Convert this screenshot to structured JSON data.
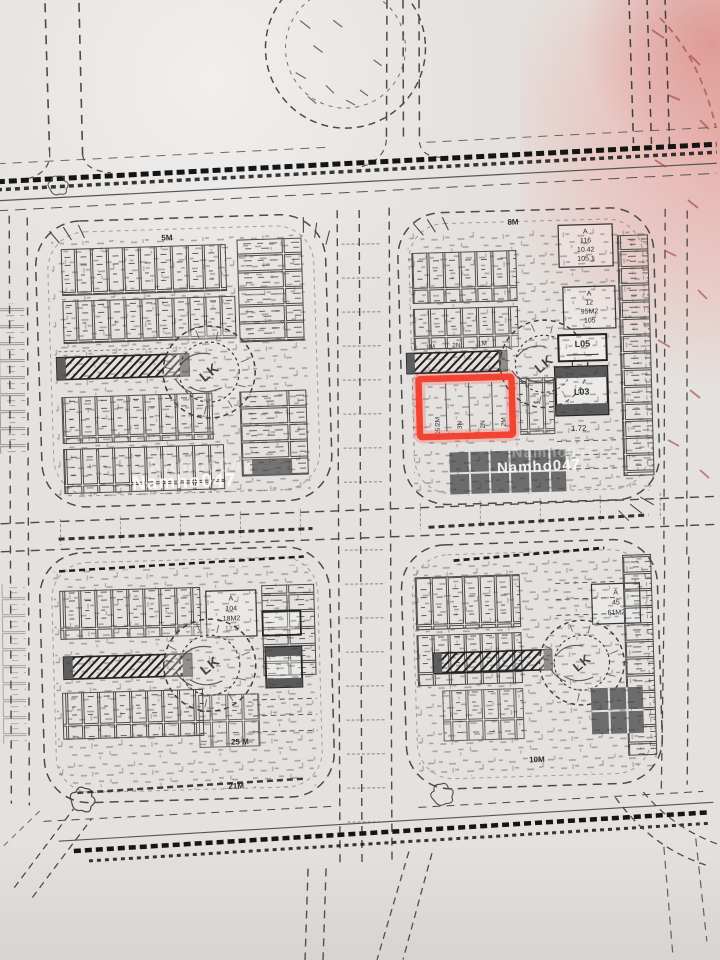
{
  "watermark": {
    "text": "Namho047"
  },
  "highlight": {
    "color": "#f43b2a"
  },
  "stamp": {
    "label": "LK"
  },
  "road_labels": {
    "tl_top": "5M",
    "tr_top": "8M",
    "bl_bottom_upper": "25 M",
    "bl_bottom_lower": "21M",
    "br_bottom": "10M"
  },
  "plot_boxes": {
    "a116": [
      "A",
      "116",
      "10.42",
      "105.1"
    ],
    "a12": [
      "A",
      "12",
      "95M2",
      "105"
    ],
    "a104": [
      "A",
      "104",
      "18M2",
      "12.5"
    ],
    "a45": [
      "A",
      "45",
      "61M2"
    ],
    "l05": "L05",
    "l03": "L03",
    "dim_below_l03": "1.72"
  },
  "tr_tick_labels": [
    "1M",
    "2N",
    "1M"
  ],
  "highlighted_plot_labels": [
    "105.2M",
    "3N",
    "2N",
    "2M"
  ]
}
